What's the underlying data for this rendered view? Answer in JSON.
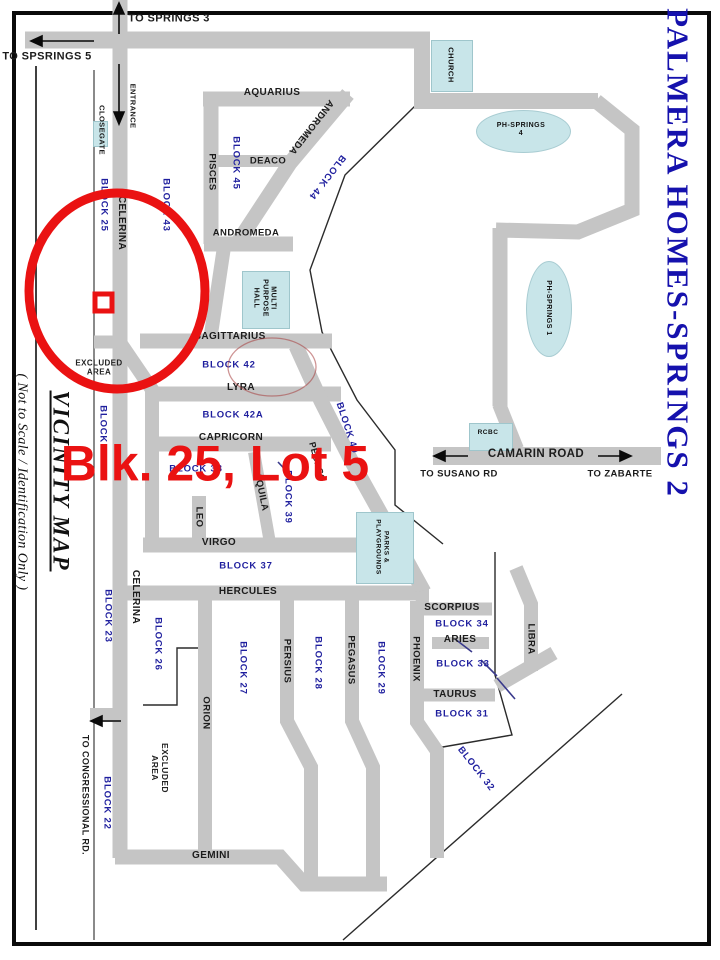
{
  "map_title": "PALMERA HOMES-SPRINGS 2",
  "map_type_caption": "VICINITY  MAP",
  "scale_caption": "( Not to Scale / Identification Only )",
  "highlight_callout": "Blk. 25, Lot 5",
  "colors": {
    "road": "#c5c5c5",
    "teal": "#c8e5e9",
    "navy": "#1f1f9e",
    "titleblue": "#1511ad",
    "red": "#ea1212",
    "ink": "#1a1a1a"
  },
  "labels": [
    {
      "n": "street-label-to-springs-3",
      "t": "TO SPRINGS 3",
      "x": 169,
      "y": 19,
      "r": 0,
      "k": "street",
      "s": 11
    },
    {
      "n": "street-label-to-spsrings-5",
      "t": "TO SPSRINGS 5",
      "x": 47,
      "y": 57,
      "r": 0,
      "k": "street",
      "s": 11
    },
    {
      "n": "street-label-entrance",
      "t": "ENTRANCE",
      "x": 132,
      "y": 106,
      "r": 90,
      "k": "street",
      "s": 7.5
    },
    {
      "n": "street-label-closegate",
      "t": "CLOSEGATE",
      "x": 101,
      "y": 130,
      "r": 90,
      "k": "street",
      "s": 7.5
    },
    {
      "n": "street-label-celerina-upper",
      "t": "CELERINA",
      "x": 121,
      "y": 223,
      "r": 90,
      "k": "street",
      "s": 10
    },
    {
      "n": "street-label-aquarius",
      "t": "AQUARIUS",
      "x": 272,
      "y": 93,
      "r": 0,
      "k": "street",
      "s": 10
    },
    {
      "n": "street-label-pisces",
      "t": "PISCES",
      "x": 212,
      "y": 172,
      "r": 90,
      "k": "street",
      "s": 9.5
    },
    {
      "n": "street-label-deaco",
      "t": "DEACO",
      "x": 268,
      "y": 161,
      "r": 0,
      "k": "street",
      "s": 9.5
    },
    {
      "n": "street-label-andromeda-diagonal",
      "t": "ANDROMEDA",
      "x": 311,
      "y": 127,
      "r": 128,
      "k": "street",
      "s": 9.5
    },
    {
      "n": "street-label-andromeda",
      "t": "ANDROMEDA",
      "x": 246,
      "y": 233,
      "r": 0,
      "k": "street",
      "s": 9.5
    },
    {
      "n": "street-label-sagittarius",
      "t": "SAGITTARIUS",
      "x": 230,
      "y": 337,
      "r": 0,
      "k": "street",
      "s": 10
    },
    {
      "n": "street-label-lyra",
      "t": "LYRA",
      "x": 241,
      "y": 388,
      "r": 0,
      "k": "street",
      "s": 10
    },
    {
      "n": "street-label-capricorn",
      "t": "CAPRICORN",
      "x": 231,
      "y": 438,
      "r": 0,
      "k": "street",
      "s": 10
    },
    {
      "n": "street-label-aquila",
      "t": "AQUILA",
      "x": 261,
      "y": 492,
      "r": 78,
      "k": "street",
      "s": 9.5
    },
    {
      "n": "street-label-leo",
      "t": "LEO",
      "x": 199,
      "y": 517,
      "r": 90,
      "k": "street",
      "s": 9.5
    },
    {
      "n": "street-label-virgo",
      "t": "VIRGO",
      "x": 219,
      "y": 543,
      "r": 0,
      "k": "street",
      "s": 10
    },
    {
      "n": "street-label-hercules",
      "t": "HERCULES",
      "x": 248,
      "y": 592,
      "r": 0,
      "k": "street",
      "s": 10
    },
    {
      "n": "street-label-persius",
      "t": "PERSIUS",
      "x": 287,
      "y": 661,
      "r": 90,
      "k": "street",
      "s": 9.5
    },
    {
      "n": "street-label-pegasus",
      "t": "PEGASUS",
      "x": 351,
      "y": 660,
      "r": 90,
      "k": "street",
      "s": 9.5
    },
    {
      "n": "street-label-pegaso-diagonal",
      "t": "PEGASO",
      "x": 317,
      "y": 462,
      "r": 75,
      "k": "street",
      "s": 9
    },
    {
      "n": "street-label-phoenix",
      "t": "PHOENIX",
      "x": 416,
      "y": 659,
      "r": 90,
      "k": "street",
      "s": 9.5
    },
    {
      "n": "street-label-orion",
      "t": "ORION",
      "x": 206,
      "y": 713,
      "r": 90,
      "k": "street",
      "s": 9.5
    },
    {
      "n": "street-label-celerina-lower",
      "t": "CELERINA",
      "x": 135,
      "y": 597,
      "r": 90,
      "k": "street",
      "s": 10
    },
    {
      "n": "street-label-scorpius",
      "t": "SCORPIUS",
      "x": 452,
      "y": 608,
      "r": 0,
      "k": "street",
      "s": 10
    },
    {
      "n": "street-label-aries",
      "t": "ARIES",
      "x": 460,
      "y": 640,
      "r": 0,
      "k": "street",
      "s": 10
    },
    {
      "n": "street-label-taurus",
      "t": "TAURUS",
      "x": 455,
      "y": 695,
      "r": 0,
      "k": "street",
      "s": 10
    },
    {
      "n": "street-label-libra",
      "t": "LIBRA",
      "x": 531,
      "y": 639,
      "r": 90,
      "k": "street",
      "s": 9.5
    },
    {
      "n": "street-label-gemini",
      "t": "GEMINI",
      "x": 211,
      "y": 856,
      "r": 0,
      "k": "street",
      "s": 10
    },
    {
      "n": "street-label-to-congressional-rd",
      "t": "TO CONGRESSIONAL RD.",
      "x": 85,
      "y": 795,
      "r": 90,
      "k": "street",
      "s": 9
    },
    {
      "n": "street-label-camarin-road",
      "t": "CAMARIN  ROAD",
      "x": 536,
      "y": 455,
      "r": 0,
      "k": "street",
      "s": 11.5
    },
    {
      "n": "street-label-to-susano-rd",
      "t": "TO SUSANO  RD",
      "x": 459,
      "y": 474,
      "r": 0,
      "k": "street",
      "s": 9.5
    },
    {
      "n": "street-label-to-zabarte",
      "t": "TO  ZABARTE",
      "x": 620,
      "y": 474,
      "r": 0,
      "k": "street",
      "s": 9.5
    },
    {
      "n": "block-label-25",
      "t": "BLOCK 25",
      "x": 104,
      "y": 205,
      "r": 90,
      "k": "block",
      "s": 9.5
    },
    {
      "n": "block-label-43",
      "t": "BLOCK 43",
      "x": 166,
      "y": 205,
      "r": 90,
      "k": "block",
      "s": 9.5
    },
    {
      "n": "block-label-45",
      "t": "BLOCK 45",
      "x": 236,
      "y": 163,
      "r": 90,
      "k": "block",
      "s": 9.5
    },
    {
      "n": "block-label-44",
      "t": "BLOCK 44",
      "x": 327,
      "y": 177,
      "r": 128,
      "k": "block",
      "s": 9.5
    },
    {
      "n": "block-label-42",
      "t": "BLOCK  42",
      "x": 229,
      "y": 365,
      "r": 0,
      "k": "block",
      "s": 9.5
    },
    {
      "n": "block-label-42a",
      "t": "BLOCK  42A",
      "x": 233,
      "y": 415,
      "r": 0,
      "k": "block",
      "s": 9.5
    },
    {
      "n": "block-label-38",
      "t": "BLOCK 38",
      "x": 196,
      "y": 469,
      "r": 0,
      "k": "block",
      "s": 9.5
    },
    {
      "n": "block-label-39",
      "t": "BLOCK 39",
      "x": 288,
      "y": 497,
      "r": 90,
      "k": "block",
      "s": 9.5
    },
    {
      "n": "block-label-40",
      "t": "BLOCK 40",
      "x": 347,
      "y": 428,
      "r": 72,
      "k": "block",
      "s": 9.5
    },
    {
      "n": "block-label-37",
      "t": "BLOCK  37",
      "x": 246,
      "y": 566,
      "r": 0,
      "k": "block",
      "s": 9.5
    },
    {
      "n": "block-label-27",
      "t": "BLOCK 27",
      "x": 243,
      "y": 668,
      "r": 90,
      "k": "block",
      "s": 9.5
    },
    {
      "n": "block-label-28",
      "t": "BLOCK 28",
      "x": 318,
      "y": 663,
      "r": 90,
      "k": "block",
      "s": 9.5
    },
    {
      "n": "block-label-29",
      "t": "BLOCK 29",
      "x": 381,
      "y": 668,
      "r": 90,
      "k": "block",
      "s": 9.5
    },
    {
      "n": "block-label-26",
      "t": "BLOCK 26",
      "x": 158,
      "y": 644,
      "r": 90,
      "k": "block",
      "s": 9.5
    },
    {
      "n": "block-label-24",
      "t": "BLOCK 24",
      "x": 103,
      "y": 432,
      "r": 90,
      "k": "block",
      "s": 9.5
    },
    {
      "n": "block-label-23",
      "t": "BLOCK 23",
      "x": 108,
      "y": 616,
      "r": 90,
      "k": "block",
      "s": 9.5
    },
    {
      "n": "block-label-22",
      "t": "BLOCK 22",
      "x": 107,
      "y": 803,
      "r": 90,
      "k": "block",
      "s": 9.5
    },
    {
      "n": "block-label-34",
      "t": "BLOCK  34",
      "x": 462,
      "y": 624,
      "r": 0,
      "k": "block",
      "s": 9.5
    },
    {
      "n": "block-label-33",
      "t": "BLOCK  33",
      "x": 463,
      "y": 664,
      "r": 0,
      "k": "block",
      "s": 9.5
    },
    {
      "n": "block-label-31",
      "t": "BLOCK  31",
      "x": 462,
      "y": 714,
      "r": 0,
      "k": "block",
      "s": 9.5
    },
    {
      "n": "block-label-32",
      "t": "BLOCK 32",
      "x": 476,
      "y": 769,
      "r": 52,
      "k": "block",
      "s": 9.5
    },
    {
      "n": "note-label-excluded-area-upper",
      "t": "EXCLUDED\nAREA",
      "x": 99,
      "y": 368,
      "r": 0,
      "k": "note",
      "s": 8
    },
    {
      "n": "note-label-excluded-area-lower",
      "t": "EXCLUDED\nAREA",
      "x": 160,
      "y": 768,
      "r": 90,
      "k": "note",
      "s": 8.5
    },
    {
      "n": "poi-label-church",
      "t": "CHURCH",
      "x": 450,
      "y": 65,
      "r": 90,
      "k": "poi",
      "s": 7.5
    },
    {
      "n": "poi-label-ph-springs-4",
      "t": "PH-SPRINGS\n4",
      "x": 521,
      "y": 130,
      "r": 0,
      "k": "poi",
      "s": 7
    },
    {
      "n": "poi-label-ph-springs-1",
      "t": "PH-SPRINGS 1",
      "x": 548,
      "y": 308,
      "r": 90,
      "k": "poi",
      "s": 7
    },
    {
      "n": "poi-label-multi-purpose-hall",
      "t": "MULTI\nPURPOSE\nHALL",
      "x": 264,
      "y": 298,
      "r": 90,
      "k": "poi",
      "s": 7
    },
    {
      "n": "poi-label-rcbc",
      "t": "RCBC",
      "x": 488,
      "y": 433,
      "r": 0,
      "k": "poi",
      "s": 6.5
    },
    {
      "n": "poi-label-parks-playgrounds",
      "t": "PARKS &\nPLAYGROUNDS",
      "x": 382,
      "y": 547,
      "r": 90,
      "k": "poi",
      "s": 6.5
    },
    {
      "n": "vicinity-map-caption",
      "t": "VICINITY  MAP",
      "x": 61,
      "y": 481,
      "r": 90,
      "k": "vicinity",
      "s": 23
    },
    {
      "n": "scale-note-caption",
      "t": "( Not to Scale / Identification Only )",
      "x": 21,
      "y": 482,
      "r": 90,
      "k": "caption",
      "s": 14
    },
    {
      "n": "map-title",
      "t": "PALMERA HOMES-SPRINGS 2",
      "x": 677,
      "y": 253,
      "r": 90,
      "k": "title",
      "s": 31
    },
    {
      "n": "lot-callout-text",
      "t": "Blk. 25, Lot 5",
      "x": 215,
      "y": 464,
      "r": 0,
      "k": "redtext",
      "s": 50
    }
  ],
  "shapes": [
    {
      "n": "church-box",
      "k": "rect",
      "x": 431,
      "y": 40,
      "w": 40,
      "h": 50
    },
    {
      "n": "closegate-box",
      "k": "rect",
      "x": 93,
      "y": 121,
      "w": 13,
      "h": 24
    },
    {
      "n": "multi-purpose-hall-box",
      "k": "rect",
      "x": 242,
      "y": 271,
      "w": 46,
      "h": 56
    },
    {
      "n": "rcbc-box",
      "k": "rect",
      "x": 469,
      "y": 423,
      "w": 42,
      "h": 26
    },
    {
      "n": "parks-playgrounds-box",
      "k": "rect",
      "x": 356,
      "y": 512,
      "w": 56,
      "h": 70
    },
    {
      "n": "ph-springs-4-ellipse",
      "k": "ellipse",
      "x": 476,
      "y": 110,
      "w": 93,
      "h": 41
    },
    {
      "n": "ph-springs-1-ellipse",
      "k": "ellipse",
      "x": 526,
      "y": 261,
      "w": 44,
      "h": 94
    }
  ]
}
